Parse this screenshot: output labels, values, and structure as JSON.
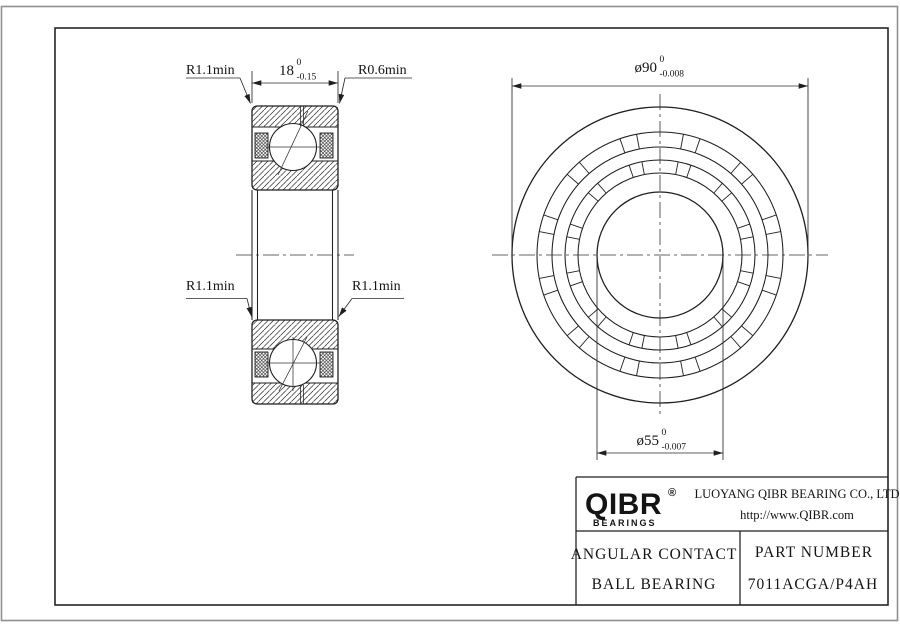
{
  "drawing": {
    "labels": {
      "radius_top_left": "R1.1min",
      "radius_top_right": "R0.6min",
      "radius_mid_left": "R1.1min",
      "radius_mid_right": "R1.1min"
    },
    "dimensions": {
      "width": {
        "value": "18",
        "upper": "0",
        "lower": "-0.15"
      },
      "outer_diameter": {
        "value": "ø90",
        "upper": "0",
        "lower": "-0.008"
      },
      "bore_diameter": {
        "value": "ø55",
        "upper": "0",
        "lower": "-0.007"
      }
    }
  },
  "title_block": {
    "logo": {
      "brand": "QIBR",
      "registered": "®",
      "tagline": "BEARINGS"
    },
    "company_name": "LUOYANG QIBR BEARING CO., LTD",
    "website": "http://www.QIBR.com",
    "product_line1": "ANGULAR CONTACT",
    "product_line2": "BALL BEARING",
    "part_number_label": "PART NUMBER",
    "part_number": "7011ACGA/P4AH"
  },
  "colors": {
    "line": "#1f1f1f",
    "sheet_border": "#8f8f8f",
    "background": "#ffffff"
  }
}
